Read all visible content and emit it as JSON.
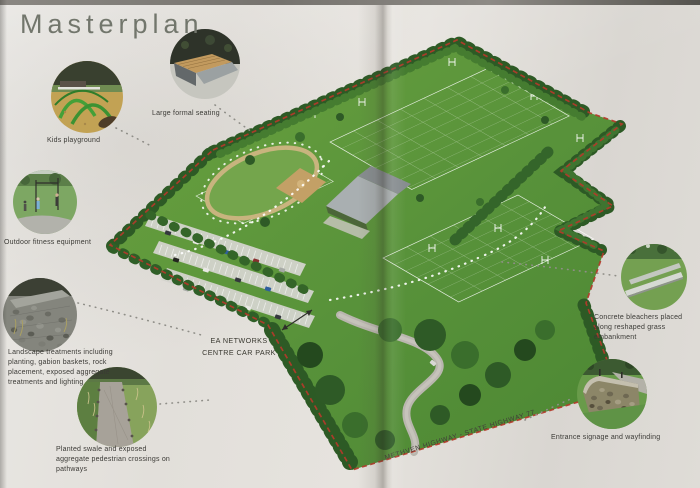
{
  "title": "Masterplan",
  "map": {
    "car_park": {
      "line1": "EA NETWORKS",
      "line2": "CENTRE CAR PARK"
    },
    "road_label": "METHVEN HIGHWAY - STATE HIGHWAY 77"
  },
  "callouts": [
    {
      "id": "kids-playground",
      "label": "Kids playground"
    },
    {
      "id": "large-formal-seating",
      "label": "Large formal seating"
    },
    {
      "id": "outdoor-fitness-equipment",
      "label": "Outdoor fitness equipment"
    },
    {
      "id": "landscape-treatments",
      "label": "Landscape treatments including planting, gabion baskets, rock placement, exposed aggregate treatments and lighting"
    },
    {
      "id": "planted-swale",
      "label": "Planted swale and exposed aggregate pedestrian crossings on pathways"
    },
    {
      "id": "concrete-bleachers",
      "label": "Concrete bleachers placed along reshaped grass embankment"
    },
    {
      "id": "entrance-signage",
      "label": "Entrance signage and wayfinding"
    }
  ],
  "colors": {
    "paper": "#e4e1dc",
    "boundary_red": "#b43a2a",
    "grass_green": "#5f9c3e",
    "title_gray": "#72766c"
  }
}
